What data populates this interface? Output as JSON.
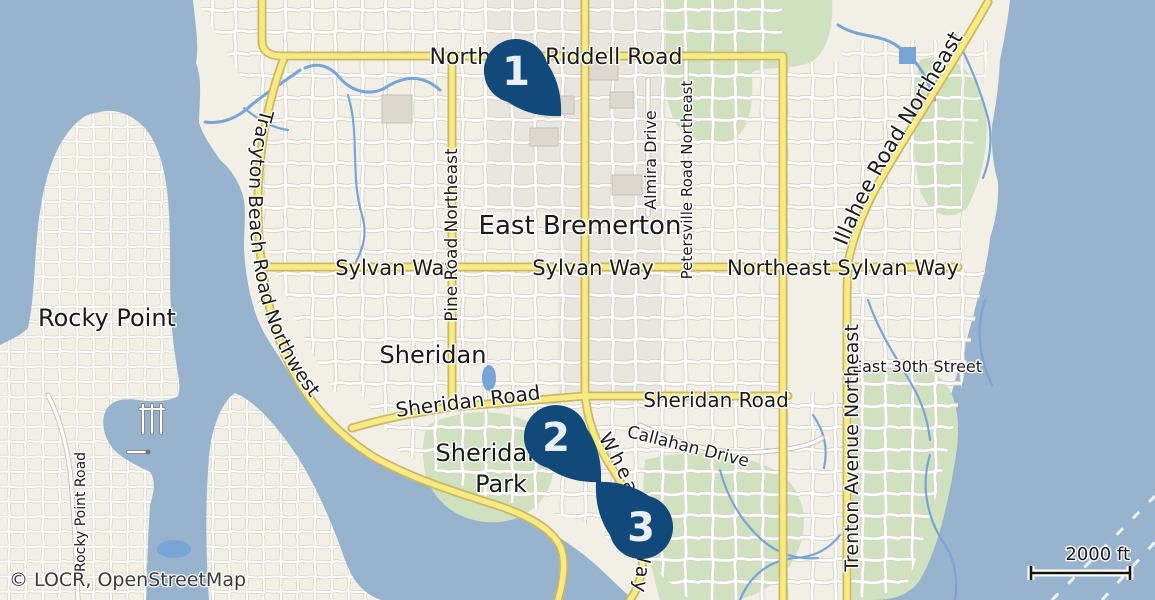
{
  "map": {
    "attribution": "© LOCR, OpenStreetMap",
    "scale_bar": {
      "label": "2000 ft"
    },
    "markers": [
      {
        "number": "1"
      },
      {
        "number": "2"
      },
      {
        "number": "3"
      }
    ],
    "labels": {
      "places": {
        "rocky_point": "Rocky Point",
        "east_bremerton": "East Bremerton",
        "sheridan": "Sheridan",
        "sheridan_park_line1": "Sheridan",
        "sheridan_park_line2": "Park"
      },
      "roads": {
        "northeast_riddell_road": "Northeast Riddell Road",
        "sylvan_way_west": "Sylvan Way",
        "sylvan_way_center": "Sylvan Way",
        "northeast_sylvan_way": "Northeast Sylvan Way",
        "pine_road_northeast": "Pine Road Northeast",
        "almira_drive": "Almira Drive",
        "petersville_road_northeast": "Petersville Road Northeast",
        "tracyton_beach_road_northwest": "Tracyton Beach Road Northwest",
        "illahee_road_northeast": "Illahee Road Northeast",
        "trenton_avenue_northeast": "Trenton Avenue Northeast",
        "east_30th_street": "East 30th Street",
        "sheridan_road_west": "Sheridan Road",
        "sheridan_road_east": "Sheridan Road",
        "callahan_drive": "Callahan Drive",
        "wheaton_way": "Wheaton Way",
        "rocky_point_road": "Rocky Point Road"
      }
    },
    "colors": {
      "water": "#97b3cd",
      "land": "#f2efe7",
      "green": "#cfe1bf",
      "stream": "#79a5d6",
      "road_major": "#f8ea85",
      "road_casing": "#ccb85f",
      "marker": "#11497a",
      "marker_text": "#e9eff6",
      "label": "#1a1a1a"
    }
  }
}
